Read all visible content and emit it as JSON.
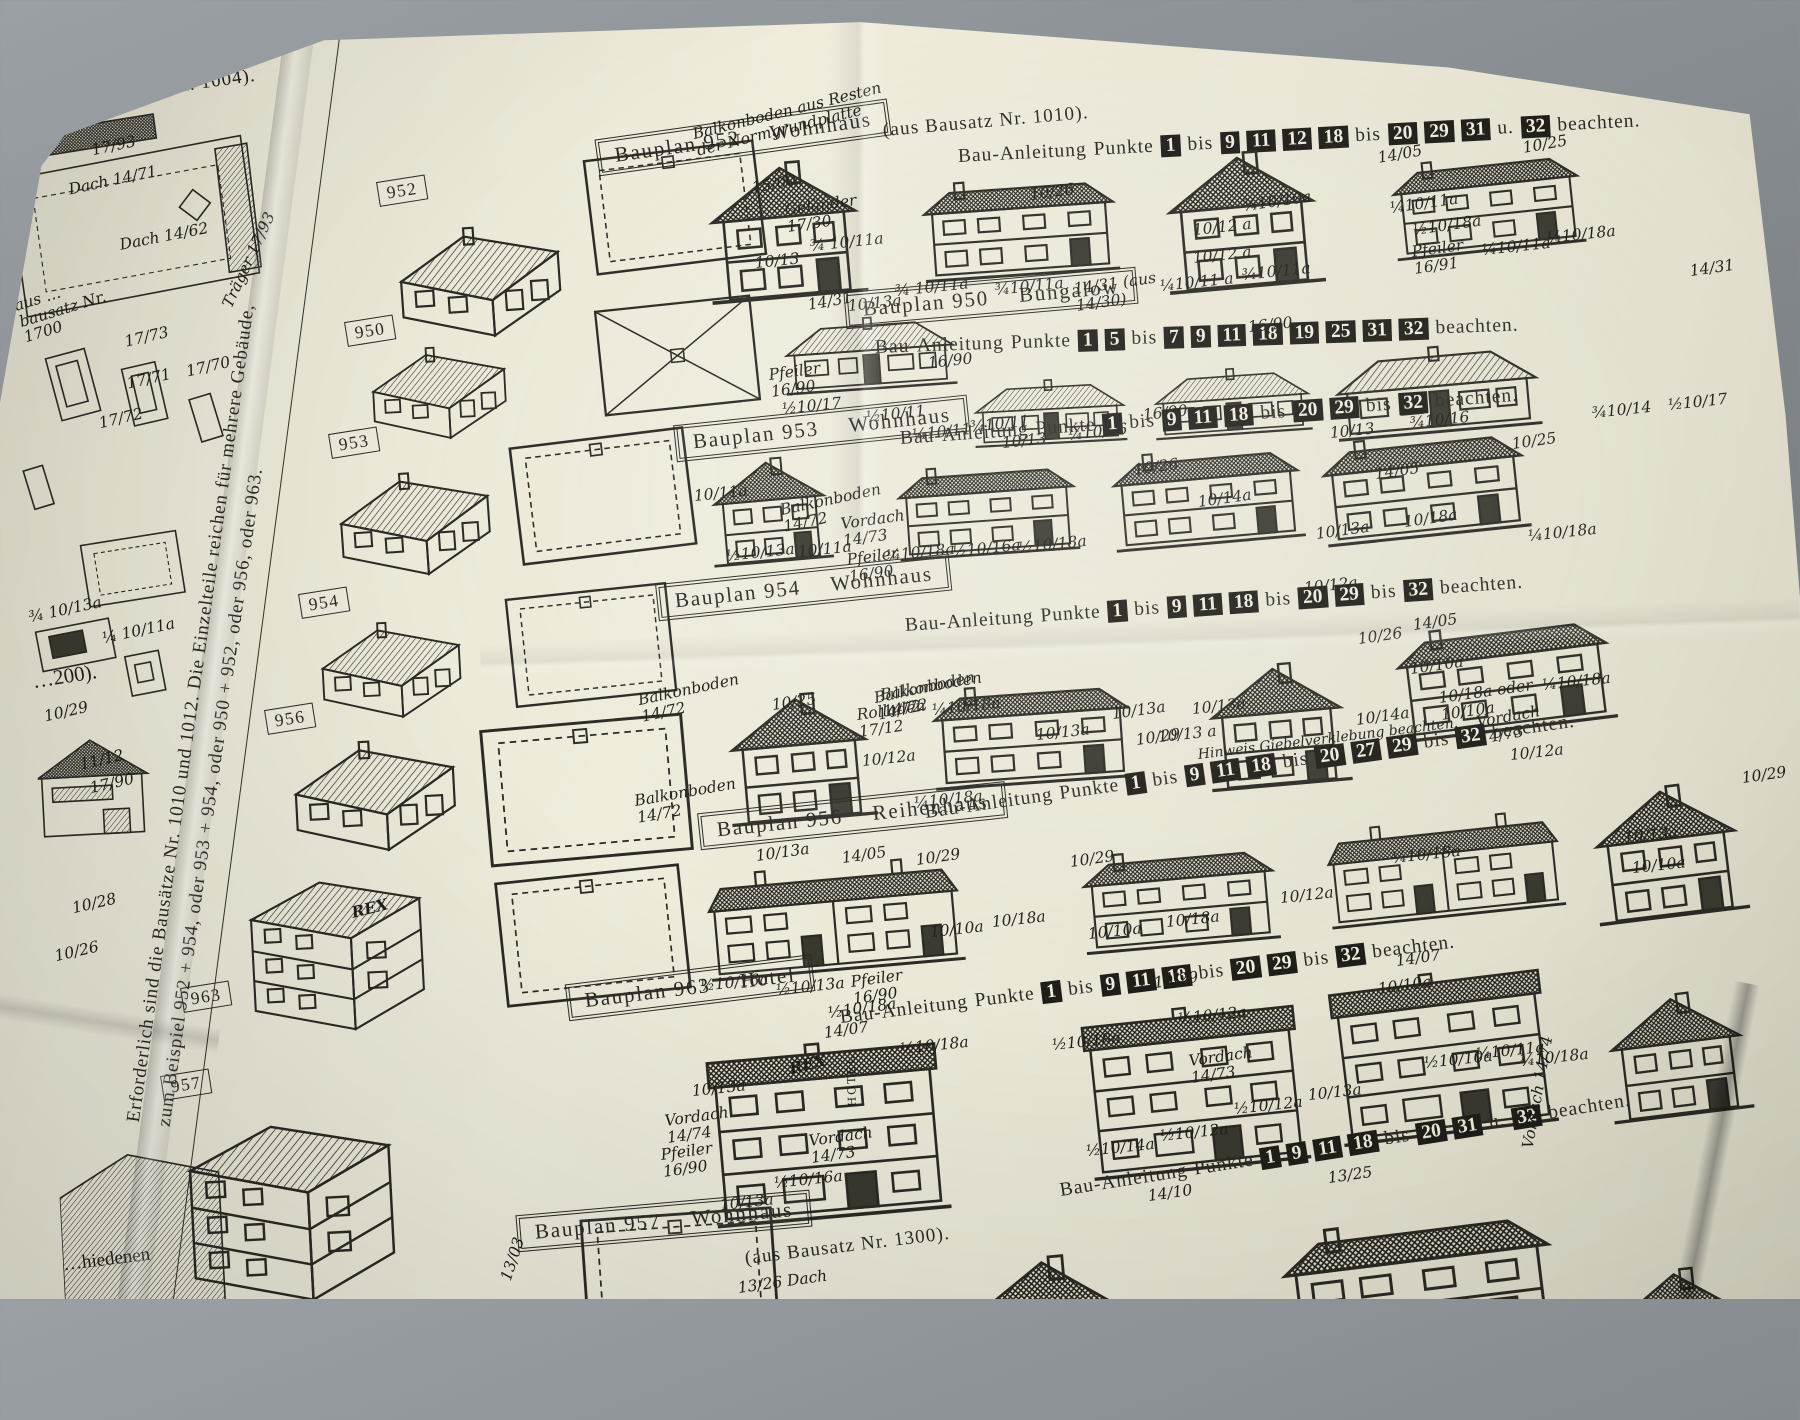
{
  "photo": {
    "backdrop": "#82878b",
    "paper": "#e9e6d6",
    "ink": "#2b2a24"
  },
  "left_panel": {
    "top_text": "ätze Nr. 1000, 1002 u. 1004).",
    "labels": [
      "17/93",
      "Dach 14/71",
      "Dach 14/62",
      "Träger 17/93",
      "aus …bausatz Nr. 1700",
      "17/73",
      "17/71",
      "17/70",
      "17/72",
      "¾ 10/13a",
      "¼ 10/11a",
      "…200).",
      "10/29",
      "11/12",
      "17/90",
      "10/28",
      "10/26",
      "…hiedenen"
    ]
  },
  "fold_note": {
    "line1": "Erforderlich sind die Bausätze Nr. 1010 und 1012. Die Einzelteile reichen für mehrere Gebäude,",
    "line2": "zum Beispiel 952 + 954, oder 953 + 954, oder 950 + 952, oder 956, oder 963."
  },
  "iso_label": "REX",
  "rows": [
    {
      "tag": "952",
      "plan": "Bauplan 952",
      "type": "Wohnhaus",
      "suffix": "(aus Bausatz Nr. 1010).",
      "instr": [
        "Bau-Anleitung",
        "Punkte",
        "1",
        "bis",
        "9",
        "11",
        "12",
        "18",
        "bis",
        "20",
        "29",
        "31",
        "u.",
        "32",
        "beachten."
      ],
      "labels": [
        "Balkonboden aus Resten der Normgrundplatte",
        "15/00",
        "Geländer 17/30",
        "10/26",
        "10/13",
        "¾ 10/11a",
        "10/13a",
        "¾ 10/11a",
        "10/12 a",
        "10/12 a",
        "¾10/11a",
        "¾10/10a",
        "14/05",
        "¼10/11a",
        "¼10/11 a",
        "¾10/11a",
        "10/25",
        "½10/18a",
        "Pfeiler 16/91",
        "¼10/11a",
        "¼10/18a"
      ]
    },
    {
      "tag": "950",
      "plan": "Bauplan 950",
      "type": "Bungalow",
      "suffix": "",
      "instr": [
        "Bau-Anleitung",
        "Punkte",
        "1",
        "5",
        "bis",
        "7",
        "9",
        "11",
        "18",
        "19",
        "25",
        "31",
        "32",
        "beachten."
      ],
      "labels": [
        "14/31",
        "14/31 (aus 14/30)",
        "16/90",
        "14/31",
        "Pfeiler 16/90",
        "½10/17",
        "½10/11",
        "¼10/11",
        "¾10/11",
        "16/90",
        "10/13",
        "¼10/16",
        "16/90",
        "10/13",
        "¾10/16",
        "¾10/14",
        "½10/17"
      ]
    },
    {
      "tag": "953",
      "plan": "Bauplan 953",
      "type": "Wohnhaus",
      "suffix": "",
      "instr": [
        "Bau-Anleitung",
        "Punkte",
        "1",
        "bis",
        "9",
        "11",
        "18",
        "bis",
        "20",
        "29",
        "bis",
        "32",
        "beachten."
      ],
      "labels": [
        "Balkonboden 14/72",
        "10/26",
        "10/14a",
        "10/13a",
        "10/11a",
        "Vordach 14/73",
        "Pfeiler 16/90",
        "½10/13a",
        "10/11a",
        "¼10/18a",
        "½10/16a",
        "½10/18a",
        "14/05",
        "10/25",
        "10/18a",
        "¼10/18a",
        "10/12a"
      ]
    },
    {
      "tag": "954",
      "plan": "Bauplan 954",
      "type": "Wohnhaus",
      "suffix": "",
      "instr": [
        "Bau-Anleitung",
        "Punkte",
        "1",
        "bis",
        "9",
        "11",
        "18",
        "bis",
        "20",
        "29",
        "bis",
        "32",
        "beachten."
      ],
      "labels": [
        "10/25",
        "Rolladen 17/12",
        "10/12a",
        "Balkonboden 14/72",
        "Balkonboden 14/72",
        "10/13a",
        "¼10/18a",
        "10/13a",
        "10/13 a",
        "10/26",
        "14/05",
        "10/10a",
        "¼10/18a",
        "10/12a"
      ]
    },
    {
      "tag": "956",
      "plan": "Bauplan 956",
      "type": "Reihenhaus",
      "suffix": "",
      "instr": [
        "Bau-Anleitung",
        "Punkte",
        "1",
        "bis",
        "9",
        "11",
        "18",
        "bis",
        "20",
        "27",
        "29",
        "bis",
        "32",
        "beachten."
      ],
      "labels": [
        "Balkonboden 14/72",
        "Balkonboden 14/72",
        "¼10/18a",
        "10/13a",
        "10/29",
        "10/13a",
        "14/05",
        "½10/16a",
        "½10/13a",
        "Pfeiler 16/90",
        "10/29",
        "10/10a",
        "10/18a",
        "10/29",
        "10/10a",
        "10/18a",
        "10/12a",
        "Hinweis Giebelverklebung beachten.",
        "Vordach 14/73",
        "10/14a",
        "10/18a oder 10/10a",
        "10/29",
        "10/13a",
        "10/10a",
        "¼10/18a"
      ]
    },
    {
      "tag": "963",
      "plan": "Bauplan 963",
      "type": "Hotel",
      "suffix": "",
      "instr": [
        "Bau-Anleitung",
        "Punkte",
        "1",
        "bis",
        "9",
        "11",
        "18",
        "bis",
        "20",
        "29",
        "bis",
        "32",
        "beachten."
      ],
      "labels": [
        "14/07",
        "14/07",
        "½10/18a",
        "10/13a",
        "Vordach 14/74",
        "Pfeiler 16/90",
        "10/13a",
        "½10/16a",
        "Vordach 14/73",
        "REX",
        "HOTEL",
        "½10/18a",
        "10/29",
        "½10/12a",
        "½10/18a",
        "Vordach 14/73",
        "½10/14a",
        "½10/12a",
        "½10/12a",
        "10/13a",
        "10/10a",
        "½10/10a",
        "¼10/11a",
        "¼10/18a"
      ]
    },
    {
      "tag": "957",
      "plan": "Bauplan 957",
      "type": "Wohnhaus",
      "suffix": "(aus Bausatz Nr. 1300).",
      "instr": [
        "Bau-Anleitung",
        "Punkte",
        "1",
        "9",
        "11",
        "18",
        "bis",
        "20",
        "31",
        "u.",
        "32",
        "beachten."
      ],
      "labels": [
        "14/10",
        "13/25",
        "Vordach 14/74",
        "13/26 Dach",
        "13/03"
      ]
    }
  ]
}
